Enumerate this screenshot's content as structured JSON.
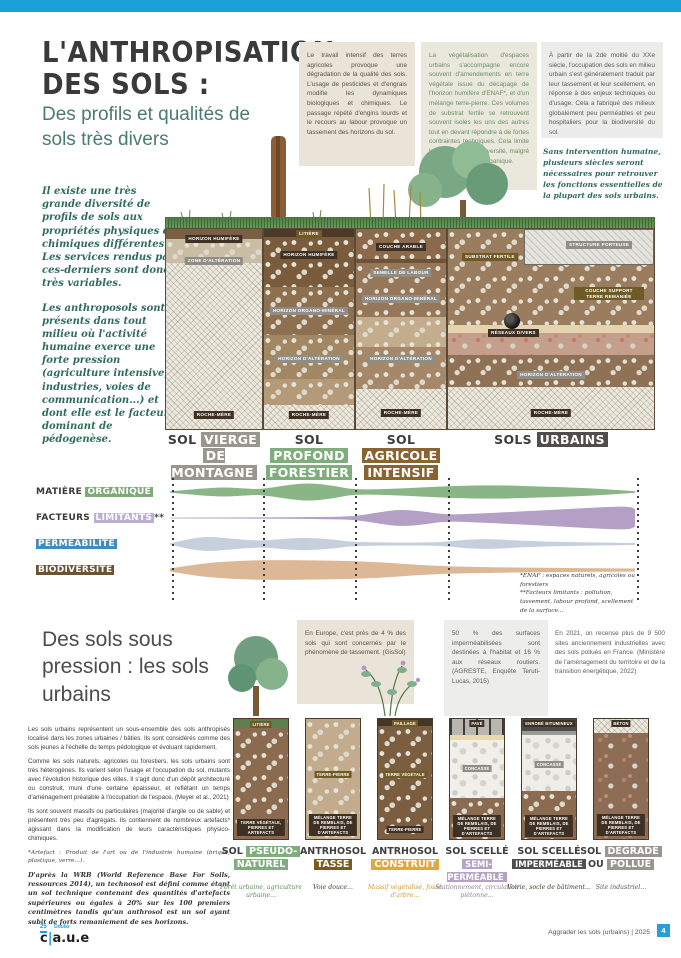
{
  "header": {
    "title_line1": "L'ANTHROPISATION",
    "title_line2": "DES SOLS :",
    "subtitle": "Des profils et qualités de sols très divers"
  },
  "intro": {
    "p1": "Il existe une très grande diversité de profils de sols aux propriétés physiques et chimiques différentes. Les services rendus par ces-derniers sont donc très variables.",
    "p2": "Les anthroposols sont présents dans tout milieu où l'activité humaine exerce une forte pression (agriculture intensive, industries, voies de communication...) et dont elle est le facteur dominant de pédogenèse."
  },
  "info_boxes": {
    "box1": "Le travail intensif des terres agricoles provoque une dégradation de la qualité des sols. L'usage de pesticides et d'engrais modifie les dynamiques biologiques et chimiques. Le passage répété d'engins lourds et le recours au labour provoque un tassement des horizons du sol.",
    "box2": "La végétalisation d'espaces urbains s'accompagne encore souvent d'amendements en terre végétale issue du décapage de l'horizon humifère d'ENAF*, et d'un mélange terre-pierre. Ces volumes de substrat fertile se retrouvent souvent isolés les uns des autres tout en devant répondre à de fortes contraintes techniques. Cela limite la présence de biodiversité, malgré l'apport de matière organique.",
    "box3": "À partir de la 2de moitié du XXe siècle, l'occupation des sols en milieu urbain s'est généralement traduit par leur tassement et leur scellement, en réponse à des enjeux techniques ou d'usage. Cela a fabriqué des milieux globalement peu perméables et peu hospitaliers pour la biodiversité du sol.",
    "quote": "Sans intervention humaine, plusieurs siècles seront nécessaires pour retrouver les fonctions essentielles de la plupart des sols urbains."
  },
  "profiles": {
    "columns": [
      {
        "name_plain": "SOL",
        "name_chip": "VIERGE",
        "name2_chip": "DE MONTAGNE",
        "layers": [
          "HORIZON HUMIFÈRE",
          "ZONE D'ALTÉRATION",
          "ROCHE-MÈRE"
        ]
      },
      {
        "name_plain": "SOL",
        "name_chip": "PROFOND",
        "name2_chip": "FORESTIER",
        "layers": [
          "LITIÈRE",
          "HORIZON HUMIFÈRE",
          "HORIZON ORGANO-MINÉRAL",
          "HORIZON D'ALTÉRATION",
          "ROCHE-MÈRE"
        ]
      },
      {
        "name_plain": "SOL",
        "name_chip": "AGRICOLE",
        "name2_chip": "INTENSIF",
        "layers": [
          "COUCHE ARABLE",
          "SEMELLE DE LABOUR",
          "HORIZON ORGANO-MINÉRAL",
          "HORIZON D'ALTÉRATION",
          "ROCHE-MÈRE"
        ]
      },
      {
        "name_plain": "SOLS",
        "name_chip": "URBAINS",
        "name2_chip": "",
        "layers": [
          "SUBSTRAT FERTILE",
          "STRUCTURE PORTEUSE",
          "COUCHE SUPPORT TERRE REMANIÉE",
          "RÉSEAUX DIVERS",
          "HORIZON D'ALTÉRATION",
          "ROCHE-MÈRE"
        ]
      }
    ]
  },
  "matrix": {
    "row1_plain": "MATIÈRE",
    "row1_chip": "ORGANIQUE",
    "row2_plain": "FACTEURS",
    "row2_chip": "LIMITANTS",
    "row2_suffix": "**",
    "row3_chip": "PERMÉABILITÉ",
    "row4_chip": "BIODIVERSITÉ",
    "footnote1": "*ENAF : espaces naturels, agricoles ou forestiers",
    "footnote2": "**Facteurs limitants : pollution, tassement, labour profond, scellement de la surface..."
  },
  "chart_data": {
    "type": "area",
    "title": "Qualités relatives des sols selon leur profil (lecture qualitative, largeur = intensité)",
    "categories": [
      "Sol vierge de montagne",
      "Sol profond forestier",
      "Sol agricole intensif",
      "Sols urbains"
    ],
    "column_boundaries_px": [
      2,
      93,
      185,
      278,
      467
    ],
    "series": [
      {
        "name": "Matière organique",
        "color": "#8ab687",
        "points": [
          [
            0,
            0.6
          ],
          [
            30,
            3.5
          ],
          [
            55,
            4.8
          ],
          [
            80,
            3.2
          ],
          [
            91,
            2.8
          ],
          [
            118,
            7
          ],
          [
            140,
            9.2
          ],
          [
            165,
            6
          ],
          [
            183,
            2.4
          ],
          [
            215,
            2.8
          ],
          [
            255,
            4.8
          ],
          [
            295,
            6.5
          ],
          [
            330,
            6.8
          ],
          [
            370,
            5.5
          ],
          [
            410,
            4.2
          ],
          [
            445,
            2.2
          ],
          [
            465,
            0.7
          ]
        ]
      },
      {
        "name": "Facteurs limitants",
        "color": "#b3a0c4",
        "points": [
          [
            0,
            0.4
          ],
          [
            60,
            0.5
          ],
          [
            120,
            0.7
          ],
          [
            160,
            1.2
          ],
          [
            183,
            1.6
          ],
          [
            205,
            5
          ],
          [
            228,
            8.5
          ],
          [
            250,
            7
          ],
          [
            276,
            3.2
          ],
          [
            310,
            4.5
          ],
          [
            350,
            6.5
          ],
          [
            390,
            8.5
          ],
          [
            425,
            10.5
          ],
          [
            450,
            11.5
          ],
          [
            462,
            11
          ],
          [
            465,
            8.5
          ]
        ]
      },
      {
        "name": "Perméabilité",
        "color": "#c6d0dc",
        "points": [
          [
            0,
            0.5
          ],
          [
            18,
            5
          ],
          [
            38,
            7.5
          ],
          [
            60,
            5.5
          ],
          [
            91,
            3
          ],
          [
            115,
            5.5
          ],
          [
            140,
            6.5
          ],
          [
            168,
            4
          ],
          [
            183,
            2
          ],
          [
            220,
            1.5
          ],
          [
            260,
            1.5
          ],
          [
            276,
            2.2
          ],
          [
            300,
            4.8
          ],
          [
            325,
            5
          ],
          [
            355,
            3
          ],
          [
            400,
            1.8
          ],
          [
            465,
            1
          ]
        ]
      },
      {
        "name": "Biodiversité",
        "color": "#ddb897",
        "points": [
          [
            0,
            1.5
          ],
          [
            30,
            6.5
          ],
          [
            70,
            9.5
          ],
          [
            110,
            10
          ],
          [
            150,
            9.5
          ],
          [
            183,
            9
          ],
          [
            215,
            7.5
          ],
          [
            250,
            5
          ],
          [
            276,
            3.8
          ],
          [
            320,
            2.8
          ],
          [
            370,
            2.2
          ],
          [
            420,
            1.8
          ],
          [
            465,
            1.5
          ]
        ]
      }
    ]
  },
  "section2": {
    "title": "Des sols sous pression : les sols urbains",
    "box1": "En Europe, c'est près de 4 % des sols qui sont concernés par le phénomène de tassement. (GisSol)",
    "box2": "50 % des surfaces imperméabilisées sont destinées à l'habitat et 16 % aux réseaux routiers. (AGRESTE, Enquête Teruti-Lucas, 2015)",
    "box3": "En 2021, on recense plus de 9 500 sites anciennement industrielles avec des sols pollués en France. (Ministère de l'aménagement du territoire et de la transition énergétique, 2022)",
    "p1": "Les sols urbains représentent un sous-ensemble des sols anthropisés localisé dans les zones urbaines / bâties. Ils sont considérés comme des sols jeunes à l'échelle du temps pédologique et évoluant rapidement.",
    "p2": "Comme les sols naturels, agricoles ou forestiers, les sols urbains sont très hétérogènes. Ils varient selon l'usage et l'occupation du sol, mutants avec l'évolution historique des villes. Il s'agit donc d'un dépôt architecturé ou construit, muni d'une certaine épaisseur, et reflétant un temps d'aménagement préalable à l'occupation de l'espace. (Meyer et al., 2021)",
    "p3": "Ils sont souvent massifs ou particulaires (majorité d'argile ou de sable) et présentent très peu d'agrégats. Ils contiennent de nombreux artefacts* agissant dans la modification de leurs caractéristiques physico-chimiques.",
    "note": "*Artefact : Produit de l'art ou de l'industrie humaine (brique, plastique, verre...).",
    "p4": "D'après la WRB (World Reference Base For Soils, ressources 2014), un technosol est défini comme étant un sol technique contenant des quantités d'artefacts supérieures ou égales à 20% sur les 100 premiers centimètres tandis qu'un anthrosol est un sol ayant subit de forts remaniement de ses horizons."
  },
  "urban_profiles": [
    {
      "t1_plain": "SOL",
      "t1_chip": "PSEUDO-",
      "t2_plain": "",
      "t2_chip": "NATUREL",
      "caption": "Forêt urbaine, agriculture urbaine...",
      "layers": [
        "LITIÈRE",
        "TERRE VÉGÉTALE, PIERRES ET ARTEFACTS"
      ]
    },
    {
      "t1_plain": "ANTRHOSOL",
      "t1_chip": "",
      "t2_plain": "",
      "t2_chip": "TASSÉ",
      "caption": "Voie douce...",
      "layers": [
        "TERRE-PIERRE",
        "MÉLANGE TERRE DE REMBLAIS, DE PIERRES ET D'ARTEFACTS"
      ]
    },
    {
      "t1_plain": "ANTRHOSOL",
      "t1_chip": "",
      "t2_plain": "",
      "t2_chip": "CONSTRUIT",
      "caption": "Massif végétalisé, fosse d'arbre...",
      "layers": [
        "PAILLAGE",
        "TERRE VÉGÉTALE",
        "TERRE-PIERRE"
      ]
    },
    {
      "t1_plain": "SOL SCELLÉ",
      "t1_chip": "",
      "t2_plain": "",
      "t2_chip": "SEMI-PERMÉABLE",
      "caption": "Stationnement, circulation piétonne...",
      "layers": [
        "PAVÉ",
        "CONCASSÉ",
        "MÉLANGE TERRE DE REMBLAIS, DE PIERRES ET D'ARTEFACTS"
      ]
    },
    {
      "t1_plain": "SOL SCELLÉ",
      "t1_chip": "",
      "t2_plain": "",
      "t2_chip": "IMPERMÉABLE",
      "caption": "Voirie, socle de bâtiment...",
      "layers": [
        "ENROBÉ BITUMINEUX",
        "CONCASSÉ",
        "MÉLANGE TERRE DE REMBLAIS, DE PIERRES ET D'ARTEFACTS"
      ]
    },
    {
      "t1_plain": "SOL",
      "t1_chip": "DÉGRADÉ",
      "t2_plain": "OU",
      "t2_chip": "POLLUÉ",
      "caption": "Site industriel...",
      "layers": [
        "BÉTON",
        "MÉLANGE TERRE DE REMBLAIS, DE PIERRES ET D'ARTEFACTS"
      ]
    }
  ],
  "footer": {
    "dept_number": "25",
    "dept_name": "Doubs",
    "logo_left": "c",
    "logo_right": "a.u.e",
    "doc_title": "Aggrader les sols (urbains) | 2025",
    "page_number": "4"
  }
}
